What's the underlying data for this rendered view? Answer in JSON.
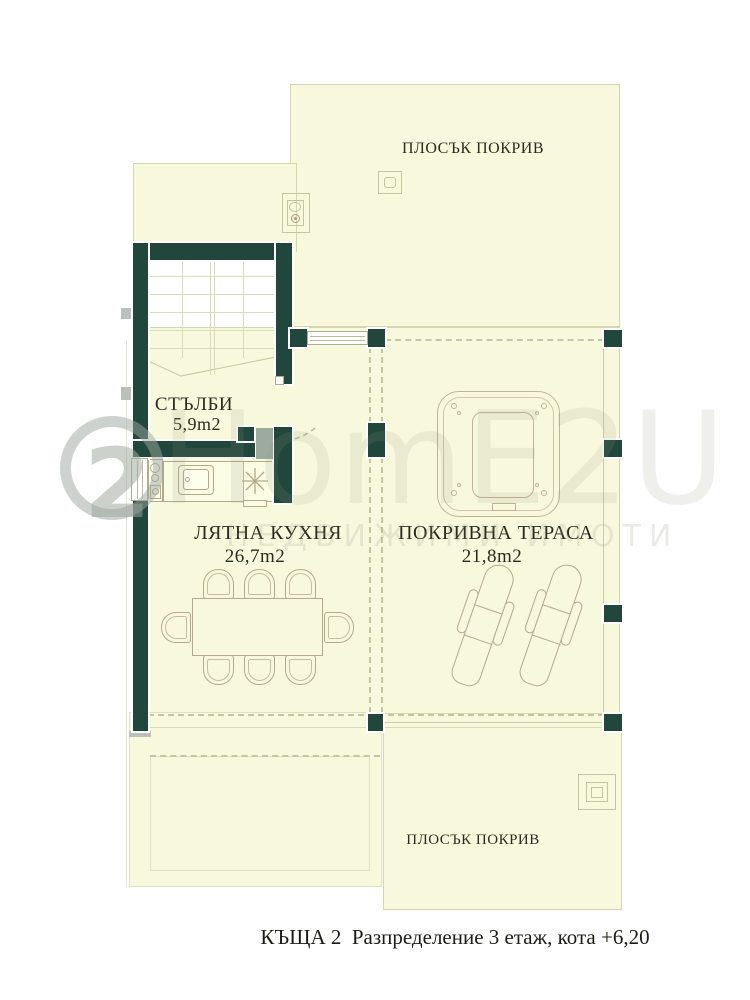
{
  "page": {
    "background": "#ffffff"
  },
  "caption": "КЪЩА 2  Разпределение 3 етаж, кота +6,20",
  "rooms": {
    "flat_roof_top": {
      "label": "ПЛОСЪК ПОКРИВ"
    },
    "stairs": {
      "label": "СТЪЛБИ",
      "area": "5,9m2"
    },
    "summer_kitchen": {
      "label": "ЛЯТНА КУХНЯ",
      "area": "26,7m2"
    },
    "roof_terrace": {
      "label": "ПОКРИВНА ТЕРАСА",
      "area": "21,8m2"
    },
    "flat_roof_bottom": {
      "label": "ПЛОСЪК ПОКРИВ"
    }
  },
  "watermark": {
    "logo_number": "2",
    "brand": "HomE2U",
    "subtitle": "НЕДВИЖИМИ ИМОТИ"
  },
  "colors": {
    "wall": "#21473c",
    "floor_fill": "#f8f9dc",
    "outline": "#d3d6b0",
    "furniture_line": "#b5a98a",
    "label_text": "#2b2b22"
  }
}
